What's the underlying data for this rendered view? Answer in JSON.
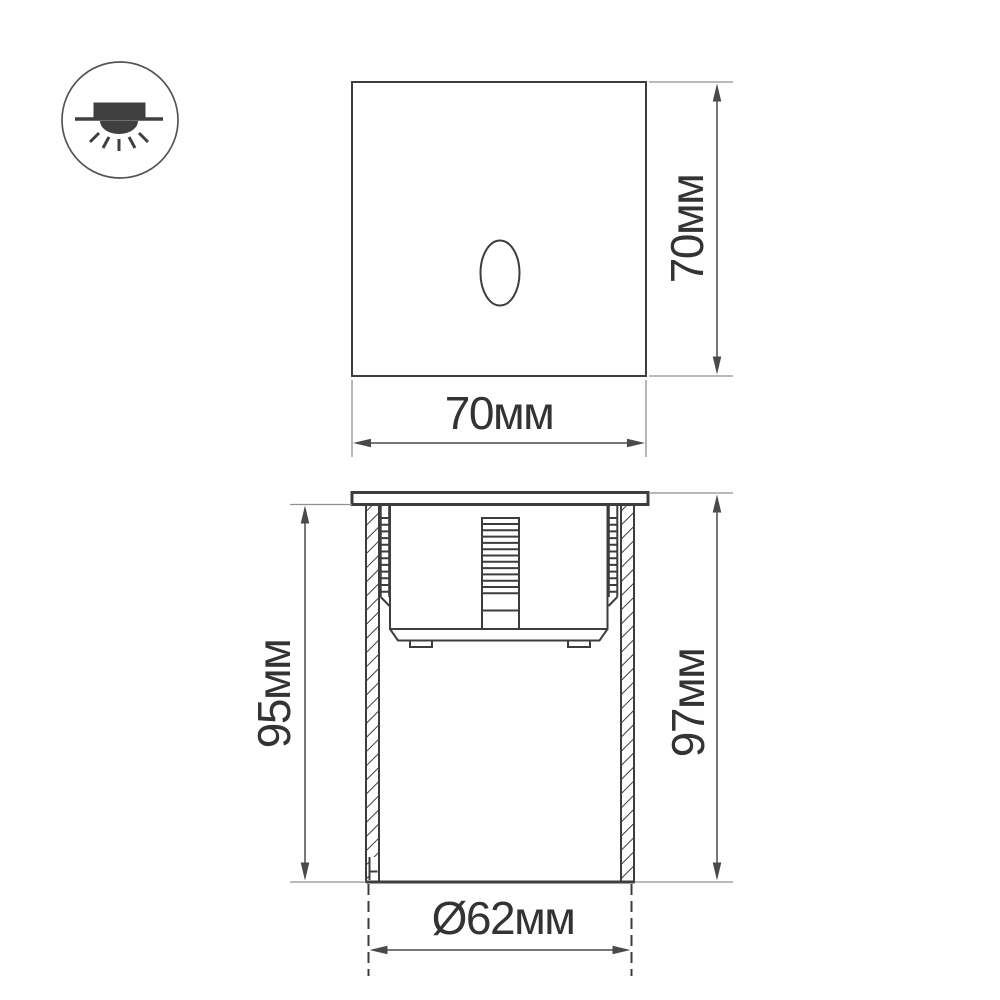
{
  "drawing": {
    "title": "recessed luminaire dimension drawing",
    "icon": {
      "meaning": "recessed-mount-downlight"
    },
    "views": {
      "front": "front face with oval light aperture",
      "section": "recessed body side section"
    },
    "dimensions": {
      "front_width": "70мм",
      "front_height": "70мм",
      "recess_depth": "95мм",
      "overall_height": "97мм",
      "cutout_diameter": "Ø62мм"
    },
    "colors": {
      "line": "#3d3d3d",
      "dim": "#4a4a4a",
      "ext": "#909090",
      "text": "#333333",
      "background": "#ffffff"
    }
  }
}
